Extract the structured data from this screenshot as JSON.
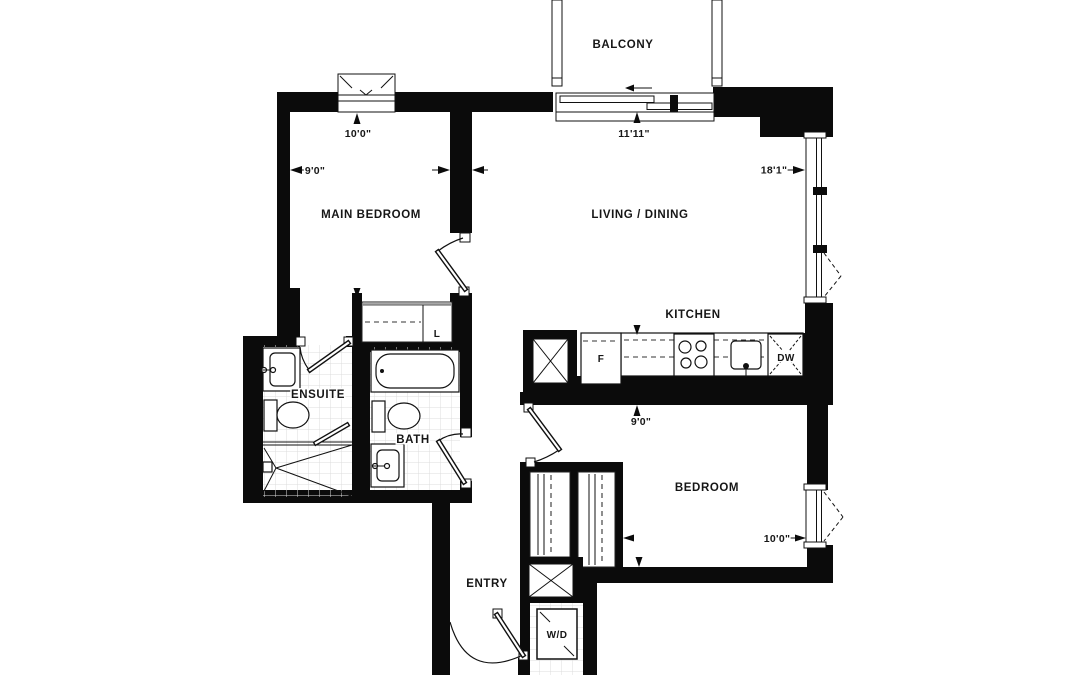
{
  "meta": {
    "kind": "apartment-floor-plan"
  },
  "colors": {
    "wall": "#0b0b0b",
    "line": "#111111",
    "tile": "#d9d9d9",
    "text": "#161616",
    "background": "#ffffff"
  },
  "rooms": {
    "balcony": "BALCONY",
    "main_bedroom": "MAIN BEDROOM",
    "living_dining": "LIVING / DINING",
    "kitchen": "KITCHEN",
    "ensuite": "ENSUITE",
    "bath": "BATH",
    "bedroom": "BEDROOM",
    "entry": "ENTRY"
  },
  "fixtures": {
    "fridge": "F",
    "dishwasher": "DW",
    "washer_dryer": "W/D",
    "linen": "L"
  },
  "dimensions": {
    "main_bedroom_width": "9'0\"",
    "main_bedroom_depth": "10'0\"",
    "living_width": "18'1\"",
    "living_depth": "11'11\"",
    "bedroom_depth": "9'0\"",
    "bedroom_width": "10'0\""
  }
}
